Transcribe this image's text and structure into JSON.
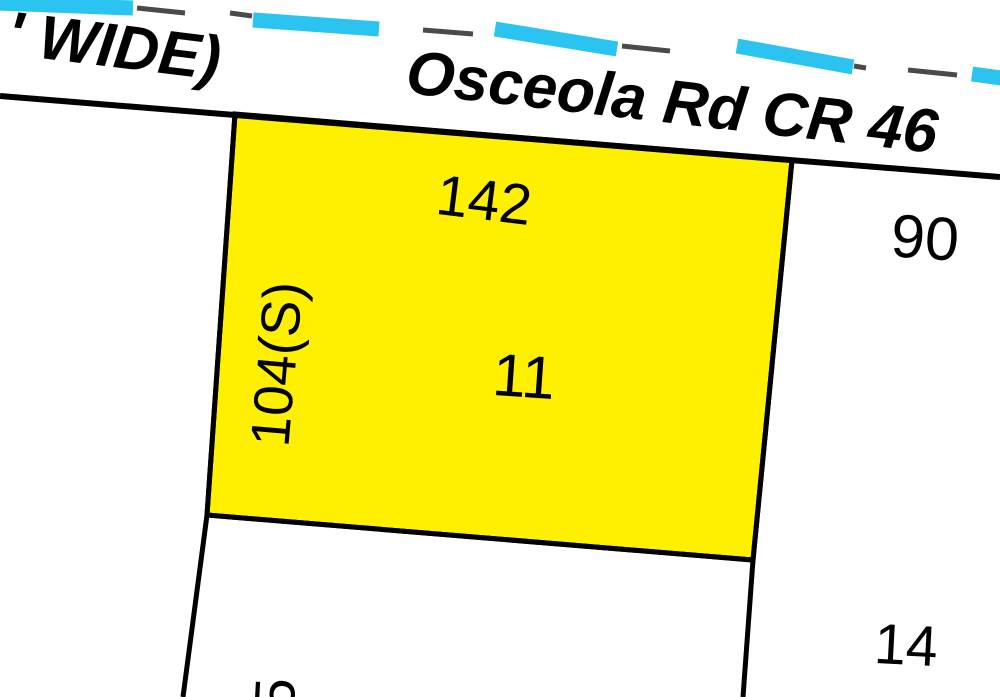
{
  "map": {
    "background_color": "#ffffff",
    "line_color": "#000000",
    "road": {
      "name": "Osceola Rd CR 46",
      "width_note": "' WIDE)"
    },
    "selected_parcel": {
      "lot_number": "11",
      "front_dimension": "142",
      "side_dimension": "104(S)",
      "fill_color": "#ffef00",
      "points": "235,114 792,160 753,560 207,515"
    },
    "neighbor_parcels": [
      {
        "label": "90"
      },
      {
        "label": "14"
      },
      {
        "label": "5"
      }
    ],
    "boundary_lines": [
      {
        "id": "road-edge-line",
        "points": "0,96 1000,177",
        "width": 6
      },
      {
        "id": "west-boundary-line",
        "points": "235,114 207,515 183,697",
        "width": 5
      },
      {
        "id": "east-boundary-line",
        "points": "792,160 753,560 743,697",
        "width": 5
      },
      {
        "id": "south-divider-line",
        "points": "207,515 753,560",
        "width": 5
      }
    ],
    "utility_line": {
      "cyan_color": "#2bc4f1",
      "gray_color": "#4a4a4a",
      "cyan_width": 15,
      "gray_width": 5,
      "cyan_dashes": [
        [
          -30,
          2,
          133,
          8
        ],
        [
          253,
          20,
          379,
          29
        ],
        [
          495,
          29,
          617,
          49
        ],
        [
          737,
          46,
          853,
          67
        ],
        [
          972,
          74,
          1105,
          92
        ]
      ],
      "gray_dashes": [
        [
          137,
          8,
          185,
          13
        ],
        [
          230,
          13,
          252,
          16
        ],
        [
          423,
          30,
          473,
          34
        ],
        [
          622,
          46,
          670,
          51
        ],
        [
          854,
          66,
          866,
          68
        ],
        [
          908,
          70,
          957,
          75
        ]
      ]
    },
    "labels": [
      {
        "id": "road-width-note",
        "text": "' WIDE)",
        "x": 114,
        "y": 47,
        "rot": 7,
        "size": 62,
        "bold": true,
        "italic": true
      },
      {
        "id": "road-name",
        "text": "Osceola Rd CR 46",
        "x": 672,
        "y": 103,
        "rot": 6.5,
        "size": 62,
        "bold": true,
        "italic": true
      },
      {
        "id": "dim-142",
        "text": "142",
        "x": 484,
        "y": 201,
        "rot": 7,
        "size": 57,
        "bold": false,
        "italic": false
      },
      {
        "id": "lot-11",
        "text": "11",
        "x": 524,
        "y": 377,
        "rot": 4,
        "size": 60,
        "bold": false,
        "italic": false
      },
      {
        "id": "dim-104s",
        "text": "104(S)",
        "x": 277,
        "y": 364,
        "rot": -85,
        "size": 55,
        "bold": false,
        "italic": false
      },
      {
        "id": "lot-90",
        "text": "90",
        "x": 925,
        "y": 238,
        "rot": 4,
        "size": 61,
        "bold": false,
        "italic": false
      },
      {
        "id": "lot-14",
        "text": "14",
        "x": 906,
        "y": 646,
        "rot": 3,
        "size": 57,
        "bold": false,
        "italic": false
      },
      {
        "id": "dim-5",
        "text": "5",
        "x": 276,
        "y": 694,
        "rot": -87,
        "size": 57,
        "bold": false,
        "italic": false
      }
    ]
  }
}
